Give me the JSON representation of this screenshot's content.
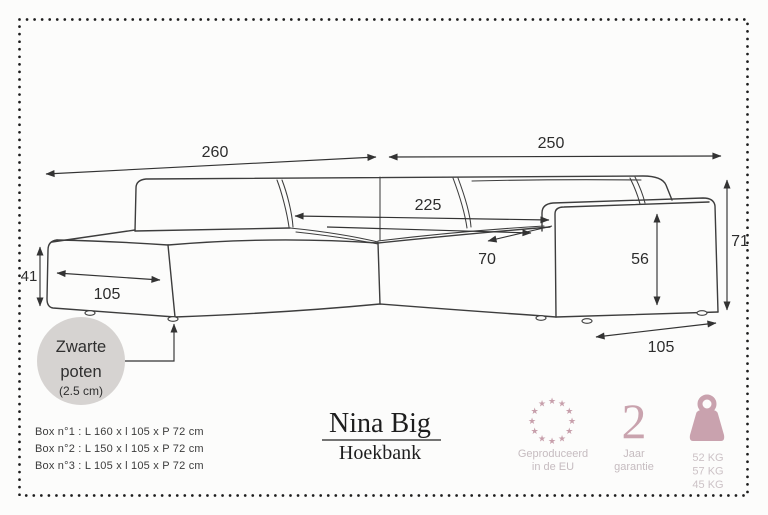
{
  "diagram": {
    "dim_total_left": "260",
    "dim_total_right": "250",
    "dim_inner_width": "225",
    "dim_seat_depth": "70",
    "dim_armrest_height": "56",
    "dim_total_height": "71",
    "dim_chaise_height": "41",
    "dim_chaise_width": "105",
    "dim_armrest_depth": "105",
    "legs_note_line1": "Zwarte",
    "legs_note_line2": "poten",
    "legs_note_line3": "(2.5 cm)"
  },
  "boxes": [
    "Box n°1 : L 160 x l 105 x P 72 cm",
    "Box n°2 : L 150 x l 105 x P 72 cm",
    "Box n°3 : L 105 x l 105 x P 72 cm"
  ],
  "product": {
    "name": "Nina Big",
    "type": "Hoekbank"
  },
  "badges": {
    "eu": {
      "star_glyph": "★",
      "caption_line1": "Geproduceerd",
      "caption_line2": "in de EU"
    },
    "warranty": {
      "number": "2",
      "caption_line1": "Jaar",
      "caption_line2": "garantie"
    },
    "weights": {
      "values": [
        "52 KG",
        "57 KG",
        "45 KG"
      ]
    }
  },
  "colors": {
    "accent_pink": "#c79fab",
    "caption": "#c6bcc0",
    "line": "#3d3d3d",
    "note_circle": "#d6d3d1"
  }
}
